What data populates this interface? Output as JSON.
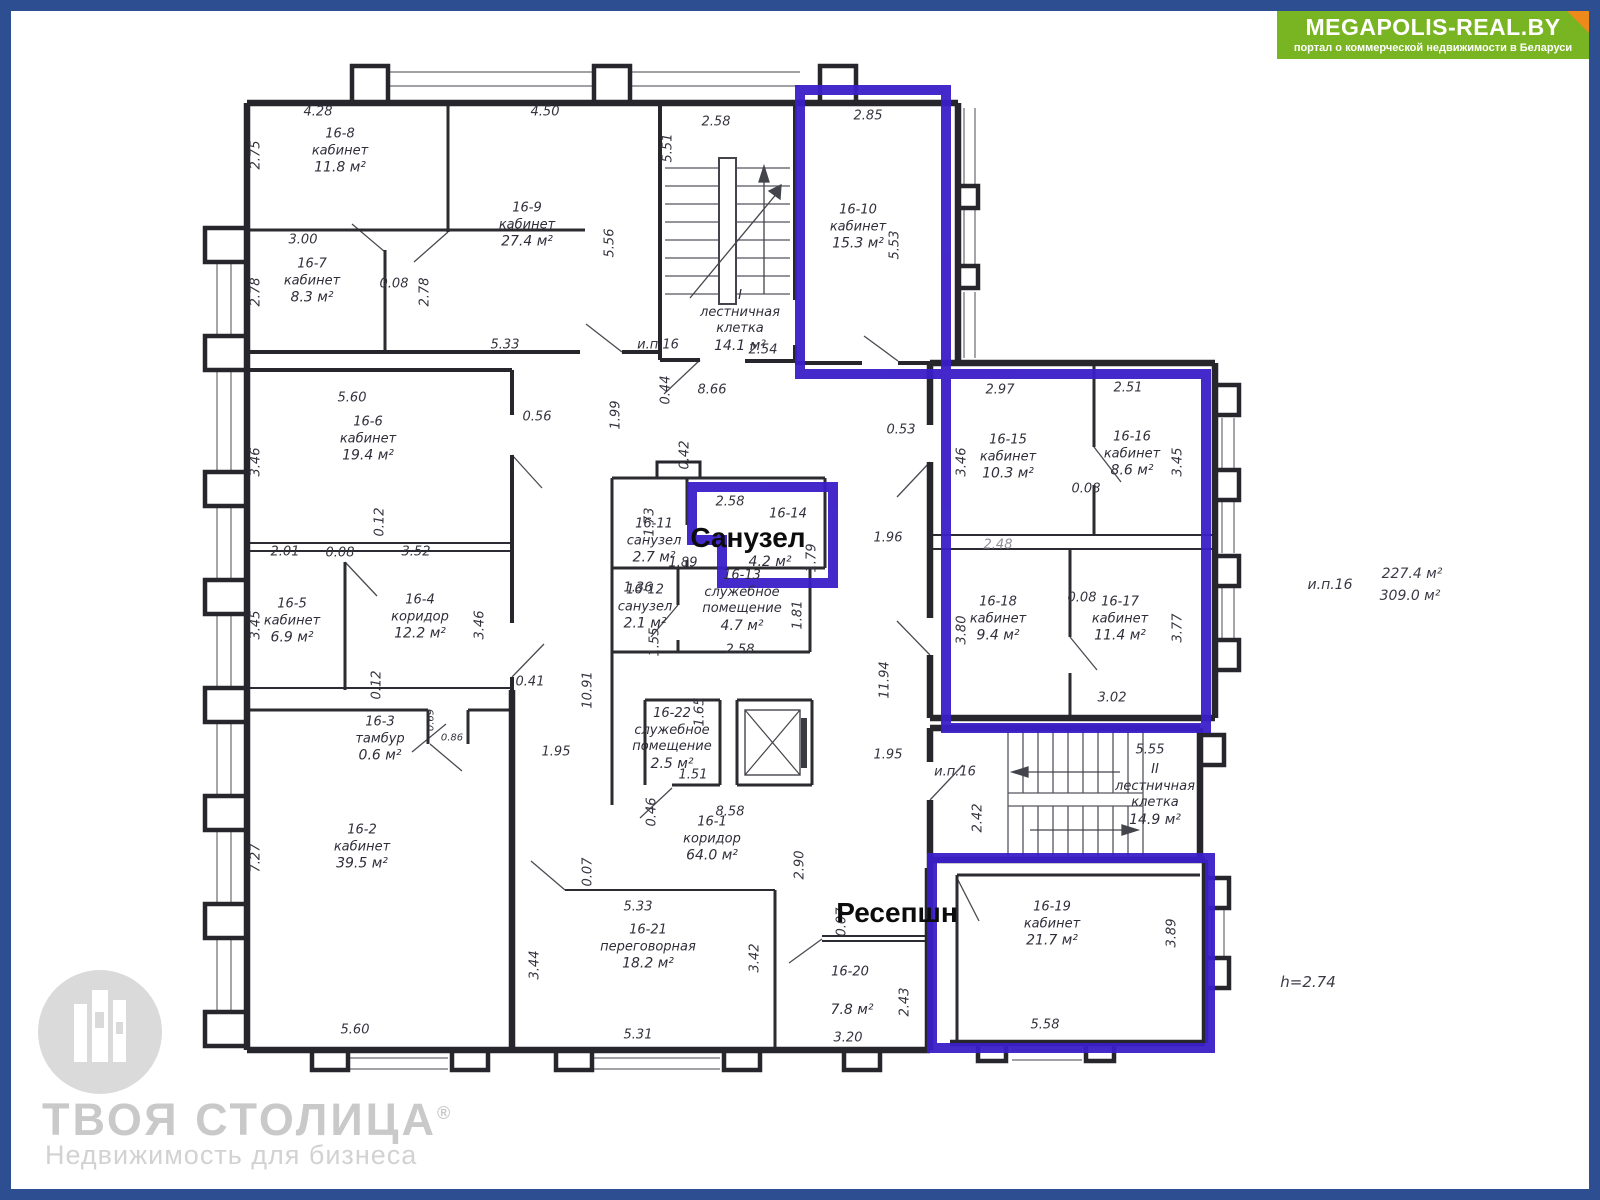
{
  "header": {
    "logo_title": "MEGAPOLIS-REAL.BY",
    "logo_subtitle": "портал о коммерческой недвижимости в Беларуси"
  },
  "watermark": {
    "brand": "ТВОЯ СТОЛИЦА",
    "reg": "®",
    "tagline": "Недвижимость для бизнеса"
  },
  "annotations": {
    "sanuzel_label": "Санузел",
    "reception_label": "Ресепшн",
    "side_unit": "и.п.16",
    "side_area_top": "227.4 м²",
    "side_area_bottom": "309.0 м²",
    "height_note": "h=2.74"
  },
  "colors": {
    "frame_blue": "#2d4e90",
    "logo_green": "#79b422",
    "logo_corner_orange": "#ee8a1c",
    "highlight_purple": "#3a1dc8",
    "wall": "#26262c",
    "watermark_gray": "#c9c9c9"
  },
  "rooms": [
    {
      "id": "16-8",
      "type": "кабинет",
      "area": "11.8 м²"
    },
    {
      "id": "16-9",
      "type": "кабинет",
      "area": "27.4 м²"
    },
    {
      "id": "16-7",
      "type": "кабинет",
      "area": "8.3 м²"
    },
    {
      "id": "16-10",
      "type": "кабинет",
      "area": "15.3 м²"
    },
    {
      "id": "I",
      "type": "лестничная",
      "type2": "клетка",
      "area": "14.1 м²"
    },
    {
      "id": "16-6",
      "type": "кабинет",
      "area": "19.4 м²"
    },
    {
      "id": "16-15",
      "type": "кабинет",
      "area": "10.3 м²"
    },
    {
      "id": "16-16",
      "type": "кабинет",
      "area": "8.6 м²"
    },
    {
      "id": "16-11",
      "type": "санузел",
      "area": "2.7 м²"
    },
    {
      "id": "16-14",
      "type": "",
      "area": "4.2 м²"
    },
    {
      "id": "16-12",
      "type": "санузел",
      "area": "2.1 м²"
    },
    {
      "id": "16-13",
      "type": "служебное",
      "type2": "помещение",
      "area": "4.7 м²"
    },
    {
      "id": "16-5",
      "type": "кабинет",
      "area": "6.9 м²"
    },
    {
      "id": "16-4",
      "type": "коридор",
      "area": "12.2 м²"
    },
    {
      "id": "16-18",
      "type": "кабинет",
      "area": "9.4 м²"
    },
    {
      "id": "16-17",
      "type": "кабинет",
      "area": "11.4 м²"
    },
    {
      "id": "16-3",
      "type": "тамбур",
      "area": "0.6 м²"
    },
    {
      "id": "16-22",
      "type": "служебное",
      "type2": "помещение",
      "area": "2.5 м²"
    },
    {
      "id": "16-2",
      "type": "кабинет",
      "area": "39.5 м²"
    },
    {
      "id": "16-1",
      "type": "коридор",
      "area": "64.0 м²"
    },
    {
      "id": "II",
      "type": "лестничная",
      "type2": "клетка",
      "area": "14.9 м²"
    },
    {
      "id": "16-19",
      "type": "кабинет",
      "area": "21.7 м²"
    },
    {
      "id": "16-21",
      "type": "переговорная",
      "area": "18.2 м²"
    },
    {
      "id": "16-20",
      "type": "",
      "area": "7.8 м²"
    }
  ],
  "dims": [
    "4.28",
    "4.50",
    "2.58",
    "2.85",
    "2.75",
    "5.51",
    "3.00",
    "5.56",
    "2.78",
    "0.08",
    "2.78",
    "5.53",
    "5.33",
    "2.54",
    "и.п.16",
    "8.66",
    "0.44",
    "1.99",
    "5.60",
    "0.56",
    "3.46",
    "0.42",
    "0.53",
    "2.97",
    "2.51",
    "3.46",
    "3.45",
    "0.08",
    "1.73",
    "2.58",
    "1.89",
    "1.79",
    "1.96",
    "2.48",
    "0.08",
    "3.80",
    "3.77",
    "3.02",
    "0.12",
    "2.01",
    "0.08",
    "3.52",
    "3.45",
    "3.46",
    "1.36",
    "1.55",
    "1.81",
    "2.58",
    "0.41",
    "10.91",
    "0.12",
    "0.69",
    "0.86",
    "1.95",
    "1.65",
    "1.51",
    "0.46",
    "8.58",
    "11.94",
    "1.95",
    "и.п.16",
    "2.42",
    "5.55",
    "0.07",
    "5.33",
    "3.44",
    "3.42",
    "5.31",
    "2.90",
    "0.07",
    "2.43",
    "3.20",
    "3.89",
    "5.58",
    "7.27",
    "5.60"
  ]
}
